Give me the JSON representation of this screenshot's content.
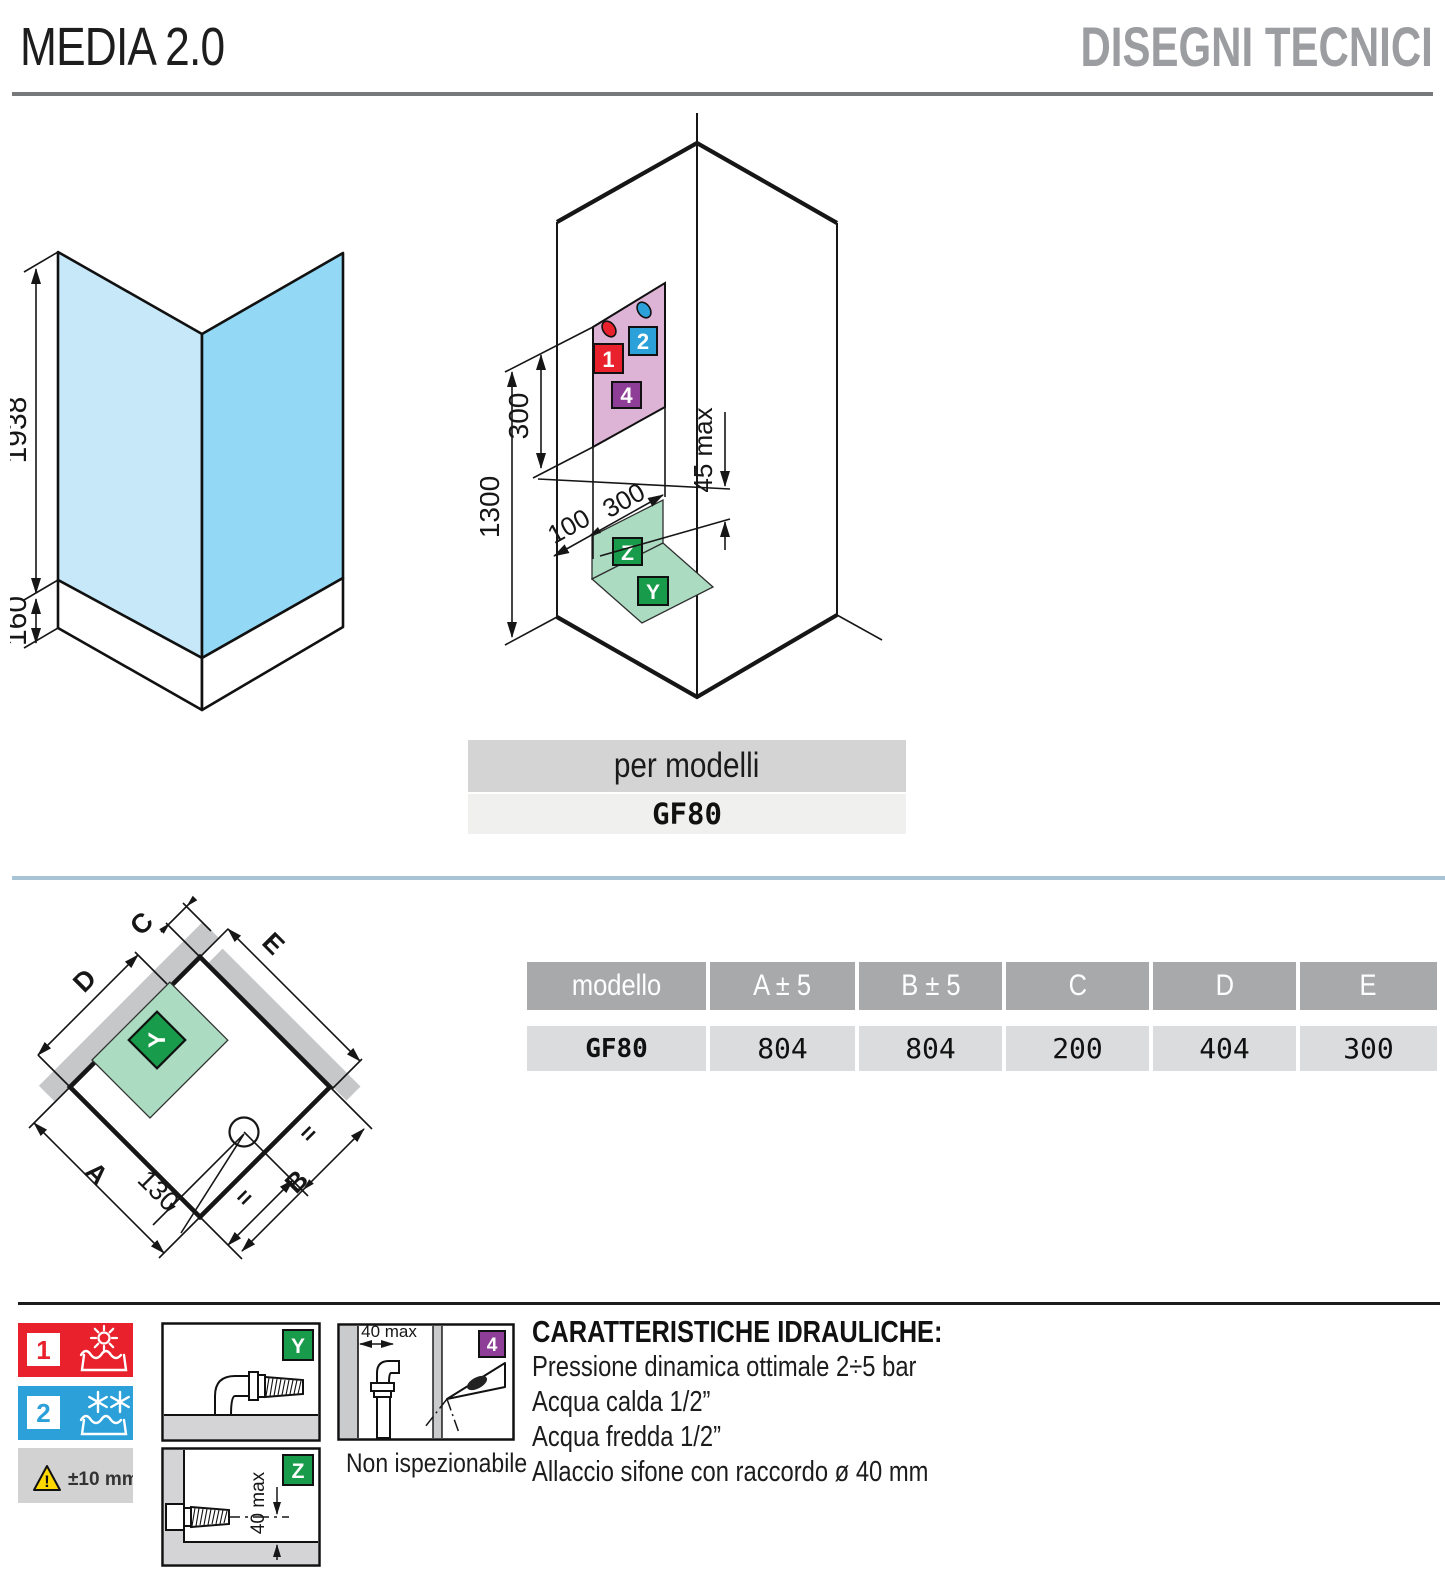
{
  "header": {
    "title": "MEDIA 2.0",
    "subtitle": "DISEGNI TECNICI"
  },
  "front_view": {
    "height_mm": "1938",
    "tray_height_mm": "160"
  },
  "iso_view": {
    "dim_panel": "300",
    "dim_total": "1300",
    "dim_offset": "100",
    "dim_width": "300",
    "dim_max": "45 max",
    "marker1": "1",
    "marker2": "2",
    "marker4": "4",
    "markerY": "Y",
    "markerZ": "Z"
  },
  "model_bar": {
    "label": "per modelli",
    "model": "GF80"
  },
  "top_view": {
    "label_a": "A",
    "label_b": "B",
    "label_c": "C",
    "label_d": "D",
    "label_e": "E",
    "label_y": "Y",
    "dim_130": "130",
    "equal_left": "=",
    "equal_right": "="
  },
  "table": {
    "headers": [
      "modello",
      "A ± 5",
      "B ± 5",
      "C",
      "D",
      "E"
    ],
    "row": [
      "GF80",
      "804",
      "804",
      "200",
      "404",
      "300"
    ]
  },
  "legend": {
    "hot_number": "1",
    "cold_number": "2",
    "tolerance": "±10 mm",
    "y_label": "Y",
    "z_label": "Z",
    "z_dim": "40 max",
    "inspection_dim": "40 max",
    "inspection_marker": "4",
    "inspection_note": "Non ispezionabile"
  },
  "hydraulics": {
    "title": "CARATTERISTICHE IDRAULICHE:",
    "lines": [
      "Pressione dinamica ottimale 2÷5 bar",
      "Acqua calda 1/2”",
      "Acqua fredda 1/2”",
      "Allaccio sifone con raccordo ø 40 mm"
    ]
  },
  "colors": {
    "accent_red": "#e8212c",
    "accent_blue": "#2ba0d9",
    "accent_purple": "#8e3e97",
    "accent_green": "#189b4a",
    "glass_light": "#c6e8f8",
    "glass_dark": "#93d8f4",
    "panel_pink": "#ddb4d6",
    "floor_green": "#abdcc2",
    "wall_gray": "#c5c7c9",
    "divider_blue": "#a9c3d6"
  }
}
